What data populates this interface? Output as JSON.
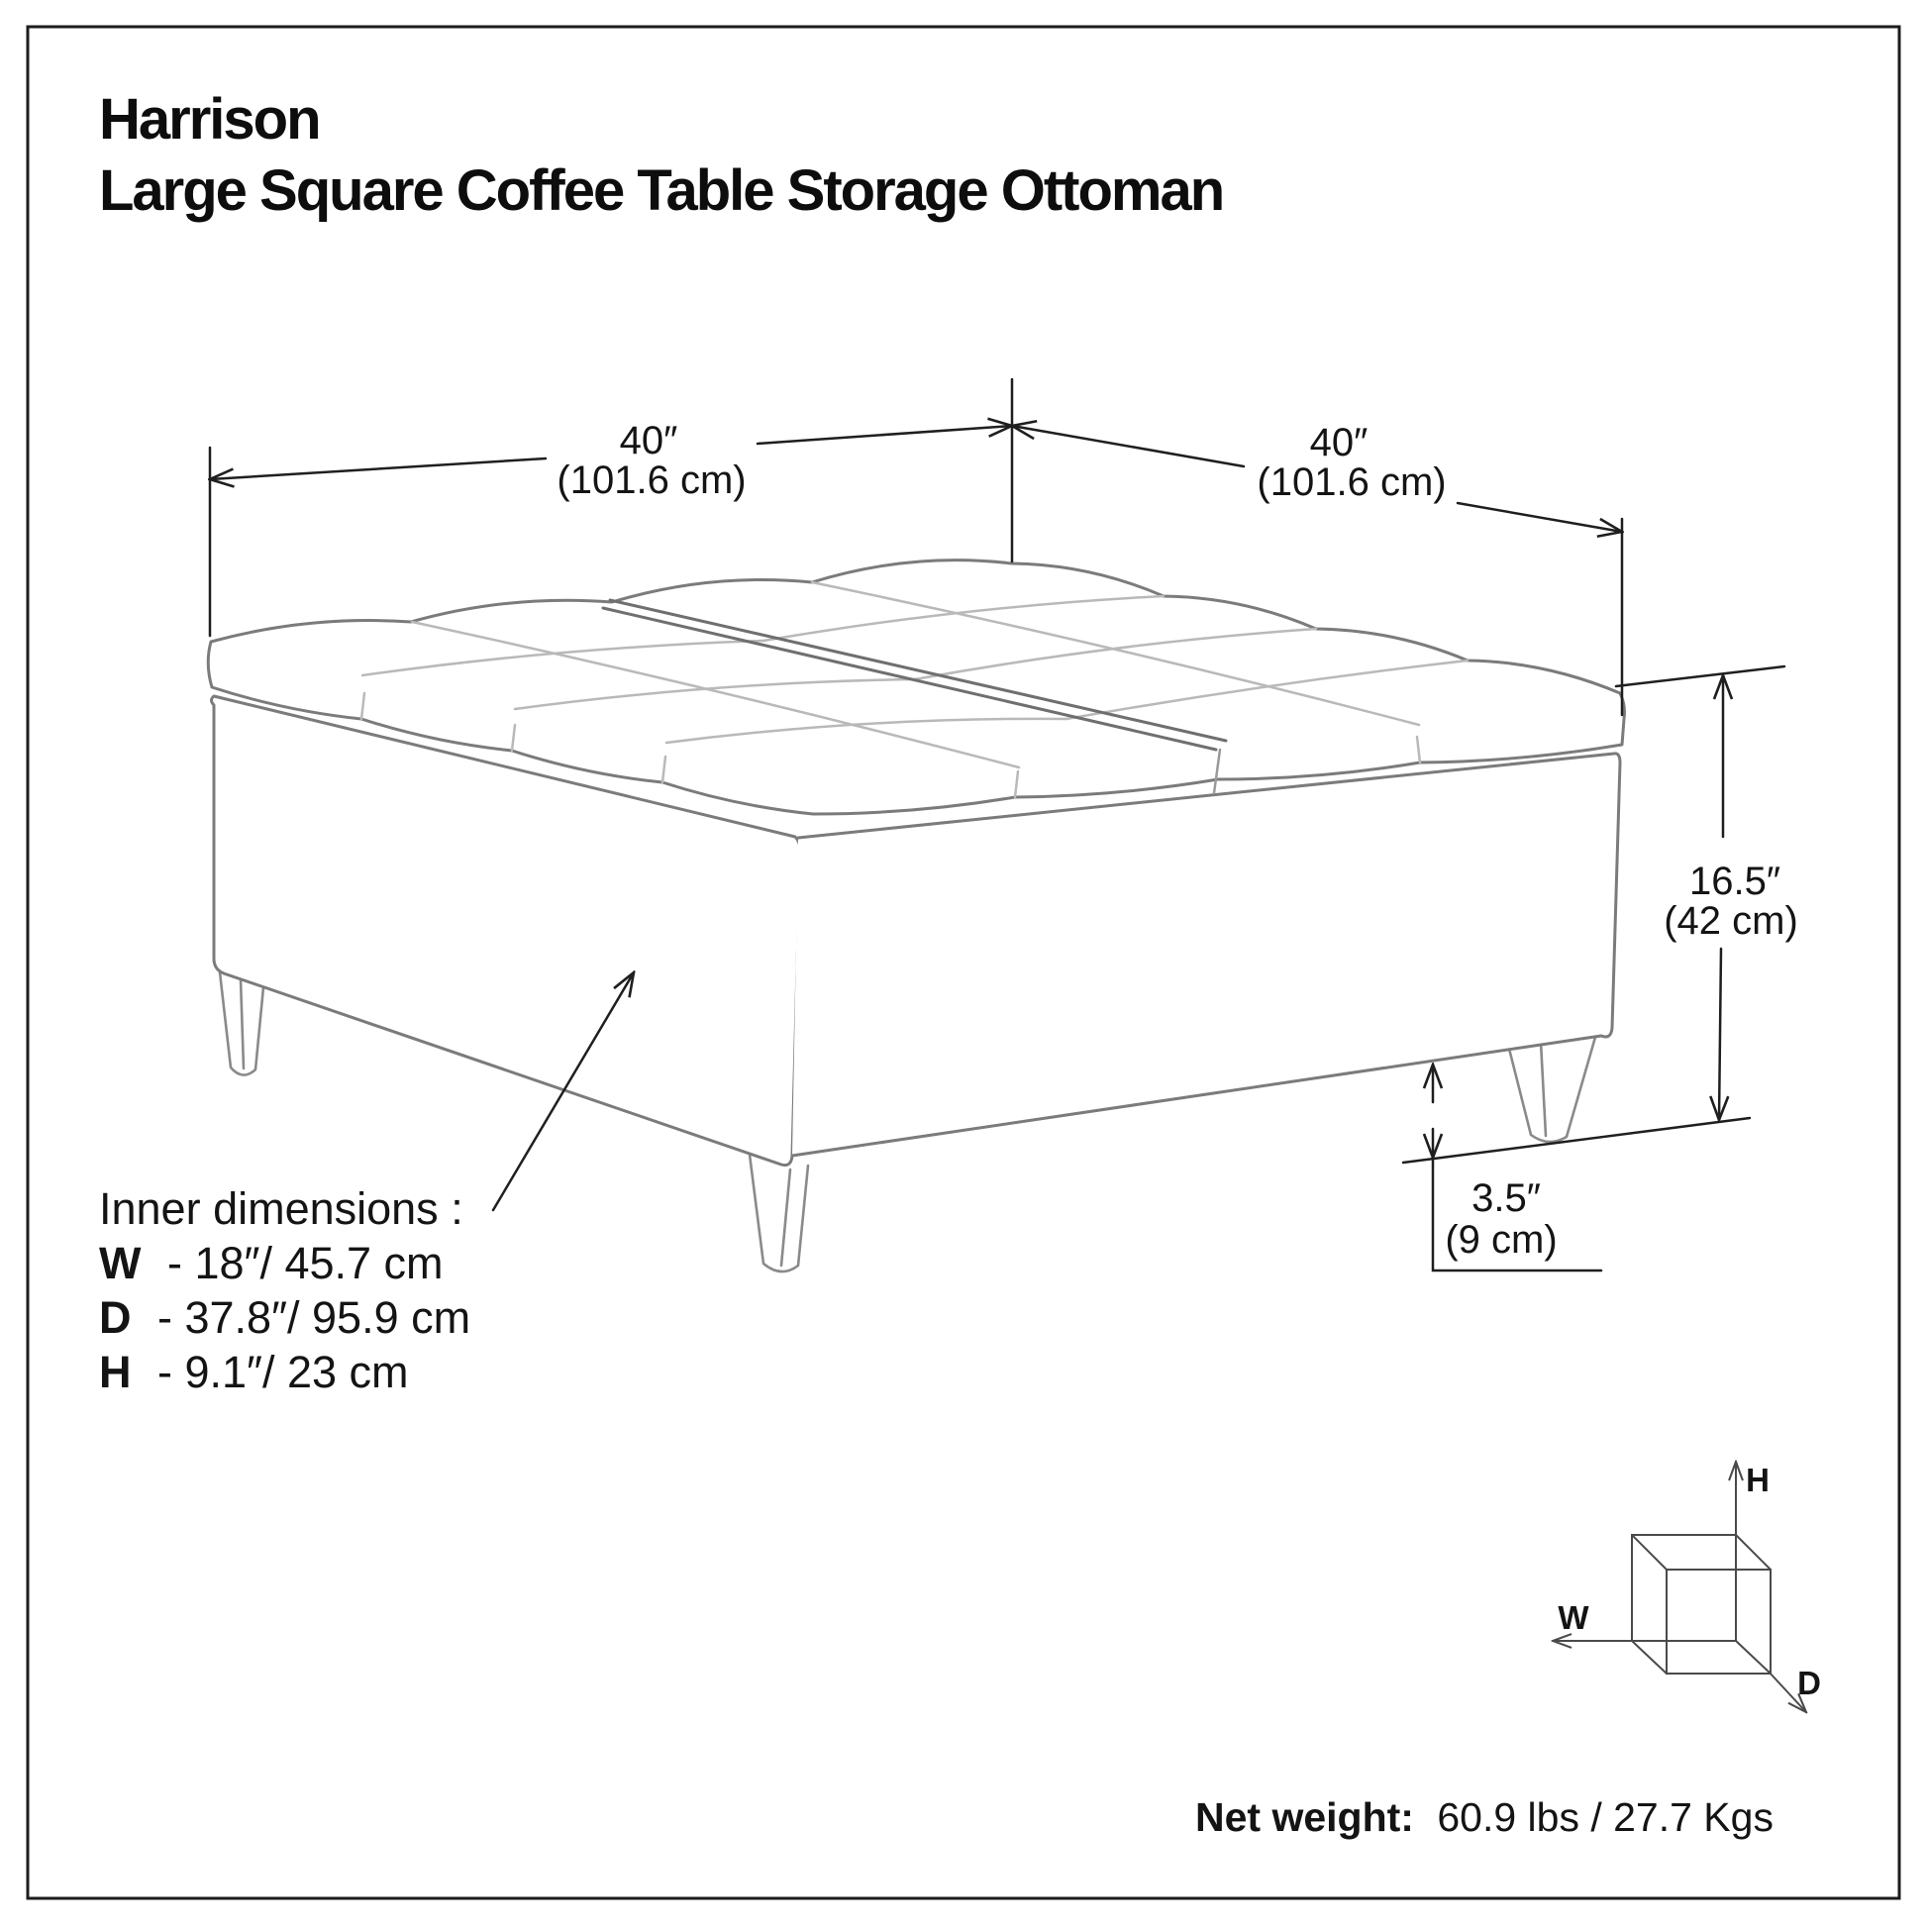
{
  "title": {
    "line1": "Harrison",
    "line2": "Large Square Coffee Table Storage Ottoman"
  },
  "dimensions": {
    "width_left": {
      "value": "40″",
      "metric": "(101.6 cm)"
    },
    "width_right": {
      "value": "40″",
      "metric": "(101.6 cm)"
    },
    "height": {
      "value": "16.5″",
      "metric": "(42 cm)"
    },
    "leg_height": {
      "value": "3.5″",
      "metric": "(9 cm)"
    }
  },
  "inner_dimensions": {
    "heading": "Inner dimensions :",
    "rows": [
      {
        "label": "W",
        "rest": "- 18″/ 45.7 cm"
      },
      {
        "label": "D",
        "rest": "- 37.8″/ 95.9 cm"
      },
      {
        "label": "H",
        "rest": "- 9.1″/ 23 cm"
      }
    ]
  },
  "axis_indicator": {
    "h": "H",
    "w": "W",
    "d": "D"
  },
  "net_weight": {
    "label": "Net weight:",
    "value": "60.9 lbs / 27.7 Kgs"
  },
  "colors": {
    "background": "#ffffff",
    "border": "#1c1c1c",
    "furniture_line": "#7b7b7b",
    "tuft_line": "#b9b9b9",
    "dimension_line": "#1f1f1f",
    "text": "#141414"
  }
}
